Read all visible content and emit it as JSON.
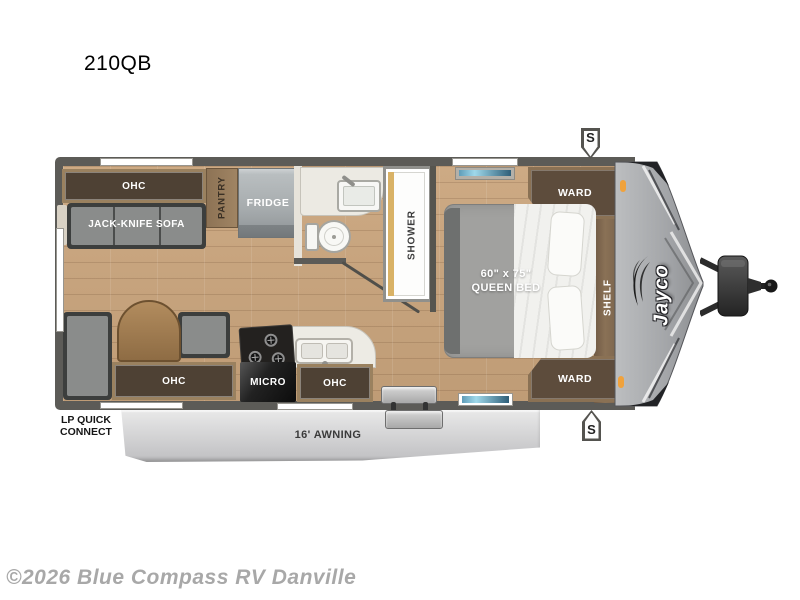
{
  "page": {
    "model": "210QB",
    "watermark": "©2026 Blue Compass RV Danville"
  },
  "palette": {
    "wall": "#5c5b57",
    "floor_wood": "#c7a47e",
    "cabinet_wood_frame": "#9a815f",
    "cabinet_wood_dark": "#4e4134",
    "marker_light_orange": "#f0a23c",
    "awning_gray": "#d9d9db",
    "window_glass_blue": "#7ec8e0"
  },
  "floorplan": {
    "brand_logo": "Jayco",
    "rear_living": {
      "ohc": "OHC",
      "sofa": "JACK-KNIFE SOFA",
      "pantry": "PANTRY",
      "fridge": "FRIDGE"
    },
    "bathroom": {
      "shower": "SHOWER"
    },
    "bedroom": {
      "ward_top": "WARD",
      "shelf": "SHELF",
      "ward_bottom": "WARD",
      "bed_size": "60\" x 75\"",
      "bed_type": "QUEEN BED"
    },
    "kitchen": {
      "micro": "MICRO",
      "ohc": "OHC"
    },
    "dinette": {
      "ohc": "OHC"
    },
    "exterior": {
      "lp_line1": "LP QUICK",
      "lp_line2": "CONNECT",
      "awning": "16' AWNING",
      "speaker_top": "S",
      "speaker_bottom": "S"
    }
  }
}
